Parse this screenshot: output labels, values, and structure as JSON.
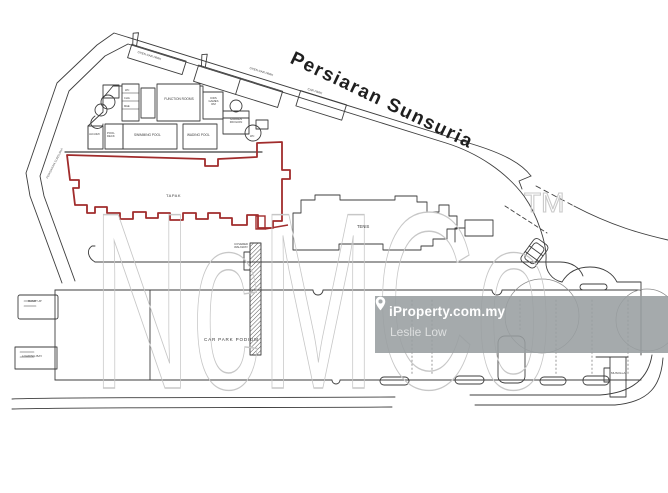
{
  "colors": {
    "boundary_red": "#a12c2c",
    "plan_line": "#3d3d3d",
    "watermark_stroke": "#c7c7c7",
    "iproperty_box": "rgba(152,158,161,0.88)"
  },
  "road": {
    "main_label": "Persiaran Sunsuria",
    "side_label": "PERSIARAN SUNSURIA"
  },
  "watermark": {
    "brand": "NcMCo",
    "trademark": "TM"
  },
  "iproperty": {
    "brand": "iProperty.com.my",
    "agent": "Leslie Low",
    "pin_icon": "map-pin-icon"
  },
  "site": {
    "label": "TAPAK"
  },
  "clubhouse": {
    "function_rooms": "FUNCTION ROOMS",
    "swimming_pool": "SWIMMING POOL",
    "wading_pool": "WADING POOL",
    "pool_deck": "POOL DECK",
    "jacuzzi": "JACUZZI",
    "changing_1": "WC",
    "changing_2": "CHG",
    "changing_3": "M&E",
    "kids_room": "KIDS GAMES RM",
    "garden_pavilion": "GARDEN PAVILION",
    "wc": "WC"
  },
  "buildings": {
    "tennis": "TENIS",
    "musolla": "MUSOLLA",
    "walkway": "COVERED WALKWAY"
  },
  "parking": {
    "podium": "CAR PARK PODIUM",
    "strip_1": "OPEN CAR PARK",
    "strip_2": "OPEN CAR PARK",
    "strip_3": "CAR PARK",
    "ramp": "RAMP UP",
    "loading": "LOADING BAY"
  }
}
